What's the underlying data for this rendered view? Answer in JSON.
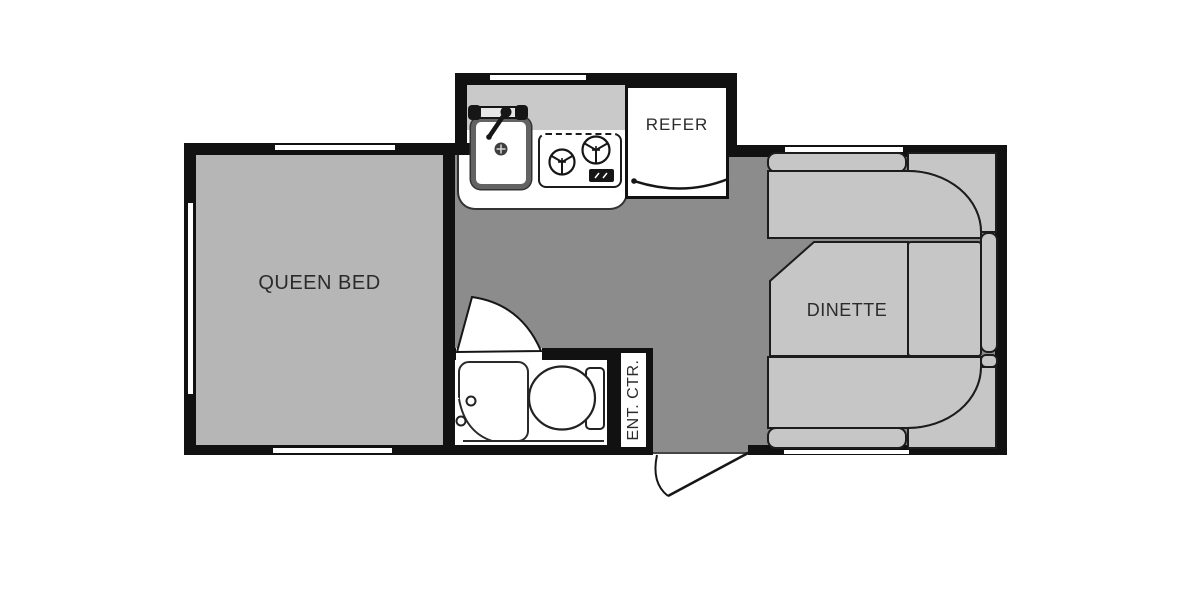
{
  "plan_title": "Travel trailer floor plan",
  "rooms": {
    "bedroom": {
      "label": "QUEEN BED"
    },
    "dinette": {
      "label": "DINETTE",
      "type": "u-shaped-booth"
    },
    "refrigerator": {
      "label": "REFER"
    },
    "entertainment_center": {
      "label": "ENT. CTR."
    },
    "kitchen": {
      "fixtures": [
        "sink-with-faucet",
        "two-burner-stove",
        "control-panel"
      ]
    },
    "bathroom": {
      "fixtures": [
        "shower-with-knobs",
        "toilet"
      ]
    }
  },
  "doors": [
    "bathroom-swing-door",
    "entry-door-exterior-swing",
    "refrigerator-door-arc"
  ],
  "windows": [
    "bedroom-left",
    "bedroom-top",
    "bedroom-bottom",
    "kitchen-top",
    "dinette-top",
    "dinette-bottom"
  ],
  "colors": {
    "wall": "#111111",
    "floor": "#8c8c8c",
    "bed_fill": "#b6b6b6",
    "cushion_fill": "#c6c6c6",
    "backsplash_fill": "#c9c9c9",
    "fixture_white": "#ffffff",
    "outline": "#1c1c1c"
  }
}
